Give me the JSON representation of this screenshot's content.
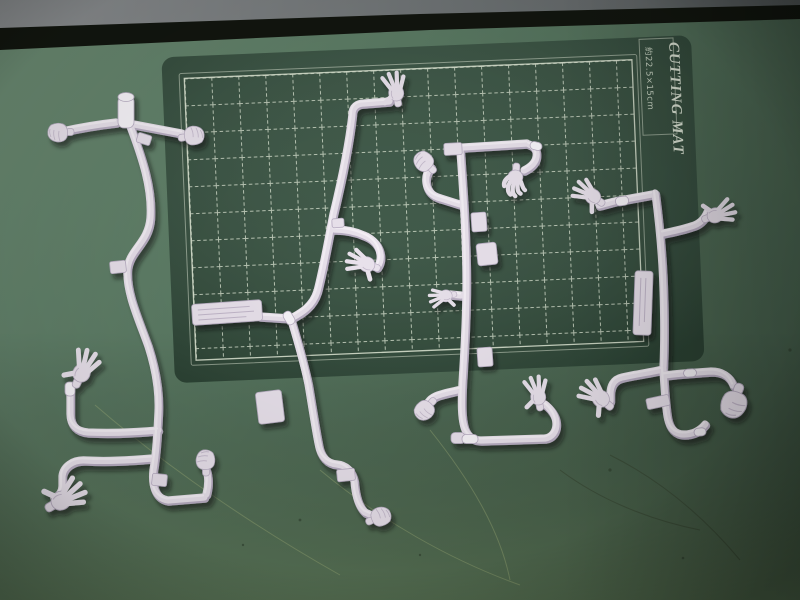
{
  "mat": {
    "title": "CUTTING MAT",
    "size_label": "約22.5×15cm"
  },
  "scene": {
    "subject": "four white plastic model-kit sprues of figure hand parts on a green cutting mat",
    "hand_part_types": [
      "open-splayed-hand",
      "closed-fist",
      "hanging-claw-hand"
    ]
  },
  "colors": {
    "table": "#5b7b64",
    "table_dark": "#47614d",
    "table_bottom": "#5a7a52",
    "band_gray": "#84888a",
    "band_dark": "#12160f",
    "mat": "#34503e",
    "mat_edge": "#2b4334",
    "grid": "#dce6d4",
    "frame": "#e4ecd9",
    "sprue": "#e9e2ec",
    "sprue_edge": "#b9aec3",
    "sprue_hi": "#f8f5fa",
    "shadow": "#10190f",
    "scratch": "#a9b87f"
  }
}
